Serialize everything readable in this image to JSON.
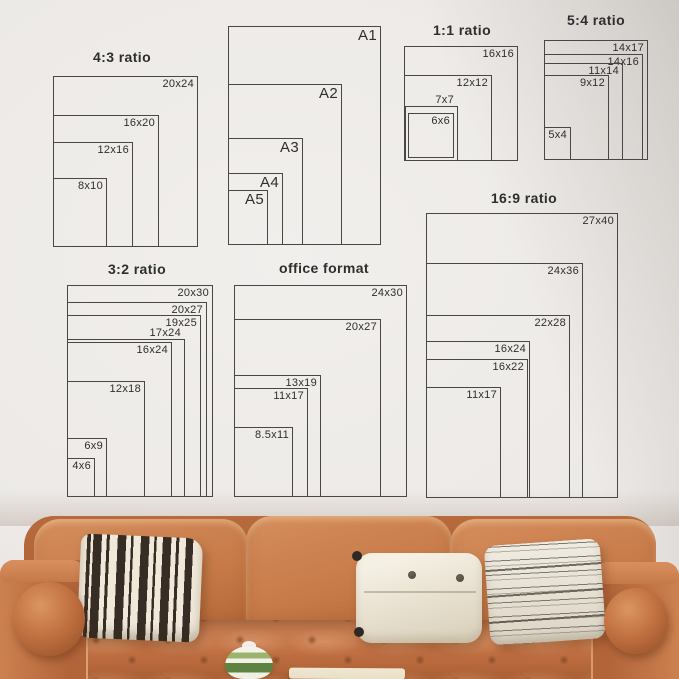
{
  "colors": {
    "wall": "#ece9e6",
    "line": "#474747",
    "text": "#2e2e2e",
    "leather": "#c57a49",
    "cream": "#f0e9da",
    "stripeDark": "#372d25",
    "green": "#7ca150"
  },
  "diagram": {
    "groups": [
      {
        "name": "ratio-4-3",
        "title": "4:3 ratio",
        "title_x": 122,
        "title_y": 49,
        "boxes": [
          {
            "label": "20x24",
            "x": 53,
            "y": 76,
            "w": 145,
            "h": 171
          },
          {
            "label": "16x20",
            "x": 53,
            "y": 115,
            "w": 106,
            "h": 132
          },
          {
            "label": "12x16",
            "x": 53,
            "y": 142,
            "w": 80,
            "h": 105
          },
          {
            "label": "8x10",
            "x": 53,
            "y": 178,
            "w": 54,
            "h": 69
          }
        ]
      },
      {
        "name": "a-series",
        "title": "",
        "title_x": 0,
        "title_y": 0,
        "boxes": [
          {
            "label": "A1",
            "x": 228,
            "y": 26,
            "w": 153,
            "h": 219,
            "size": 15
          },
          {
            "label": "A2",
            "x": 228,
            "y": 84,
            "w": 114,
            "h": 161,
            "size": 15
          },
          {
            "label": "A3",
            "x": 228,
            "y": 138,
            "w": 75,
            "h": 107,
            "size": 15
          },
          {
            "label": "A4",
            "x": 228,
            "y": 173,
            "w": 55,
            "h": 72,
            "size": 15
          },
          {
            "label": "A5",
            "x": 228,
            "y": 190,
            "w": 40,
            "h": 55,
            "size": 15
          }
        ]
      },
      {
        "name": "ratio-1-1",
        "title": "1:1 ratio",
        "title_x": 462,
        "title_y": 22,
        "boxes": [
          {
            "label": "16x16",
            "x": 404,
            "y": 46,
            "w": 114,
            "h": 115
          },
          {
            "label": "12x12",
            "x": 404,
            "y": 75,
            "w": 88,
            "h": 86
          },
          {
            "label": "7x7",
            "x": 405,
            "y": 106,
            "w": 53,
            "h": 55,
            "above": true
          },
          {
            "label": "6x6",
            "x": 408,
            "y": 113,
            "w": 46,
            "h": 45
          }
        ]
      },
      {
        "name": "ratio-5-4",
        "title": "5:4 ratio",
        "title_x": 596,
        "title_y": 12,
        "boxes": [
          {
            "label": "14x17",
            "x": 544,
            "y": 40,
            "w": 104,
            "h": 120
          },
          {
            "label": "14x16",
            "x": 544,
            "y": 54,
            "w": 99,
            "h": 106
          },
          {
            "label": "11x14",
            "x": 544,
            "y": 63,
            "w": 79,
            "h": 97
          },
          {
            "label": "9x12",
            "x": 544,
            "y": 75,
            "w": 65,
            "h": 85
          },
          {
            "label": "5x4",
            "x": 544,
            "y": 127,
            "w": 27,
            "h": 33
          }
        ]
      },
      {
        "name": "ratio-3-2",
        "title": "3:2 ratio",
        "title_x": 137,
        "title_y": 261,
        "boxes": [
          {
            "label": "20x30",
            "x": 67,
            "y": 285,
            "w": 146,
            "h": 212
          },
          {
            "label": "20x27",
            "x": 67,
            "y": 302,
            "w": 140,
            "h": 195
          },
          {
            "label": "19x25",
            "x": 67,
            "y": 315,
            "w": 134,
            "h": 182
          },
          {
            "label": "17x24",
            "x": 67,
            "y": 339,
            "w": 118,
            "h": 158,
            "above": true
          },
          {
            "label": "16x24",
            "x": 67,
            "y": 342,
            "w": 105,
            "h": 155
          },
          {
            "label": "12x18",
            "x": 67,
            "y": 381,
            "w": 78,
            "h": 116
          },
          {
            "label": "6x9",
            "x": 67,
            "y": 438,
            "w": 40,
            "h": 59
          },
          {
            "label": "4x6",
            "x": 67,
            "y": 458,
            "w": 28,
            "h": 39
          }
        ]
      },
      {
        "name": "office-format",
        "title": "office format",
        "title_x": 324,
        "title_y": 260,
        "boxes": [
          {
            "label": "24x30",
            "x": 234,
            "y": 285,
            "w": 173,
            "h": 212
          },
          {
            "label": "20x27",
            "x": 234,
            "y": 319,
            "w": 147,
            "h": 178
          },
          {
            "label": "13x19",
            "x": 234,
            "y": 375,
            "w": 87,
            "h": 122
          },
          {
            "label": "11x17",
            "x": 234,
            "y": 388,
            "w": 74,
            "h": 109
          },
          {
            "label": "8.5x11",
            "x": 234,
            "y": 427,
            "w": 59,
            "h": 70
          }
        ]
      },
      {
        "name": "ratio-16-9",
        "title": "16:9 ratio",
        "title_x": 524,
        "title_y": 190,
        "boxes": [
          {
            "label": "27x40",
            "x": 426,
            "y": 213,
            "w": 192,
            "h": 285
          },
          {
            "label": "24x36",
            "x": 426,
            "y": 263,
            "w": 157,
            "h": 235
          },
          {
            "label": "22x28",
            "x": 426,
            "y": 315,
            "w": 144,
            "h": 183
          },
          {
            "label": "16x24",
            "x": 426,
            "y": 341,
            "w": 104,
            "h": 157
          },
          {
            "label": "16x22",
            "x": 426,
            "y": 359,
            "w": 102,
            "h": 139
          },
          {
            "label": "11x17",
            "x": 426,
            "y": 387,
            "w": 75,
            "h": 111
          }
        ]
      }
    ]
  }
}
